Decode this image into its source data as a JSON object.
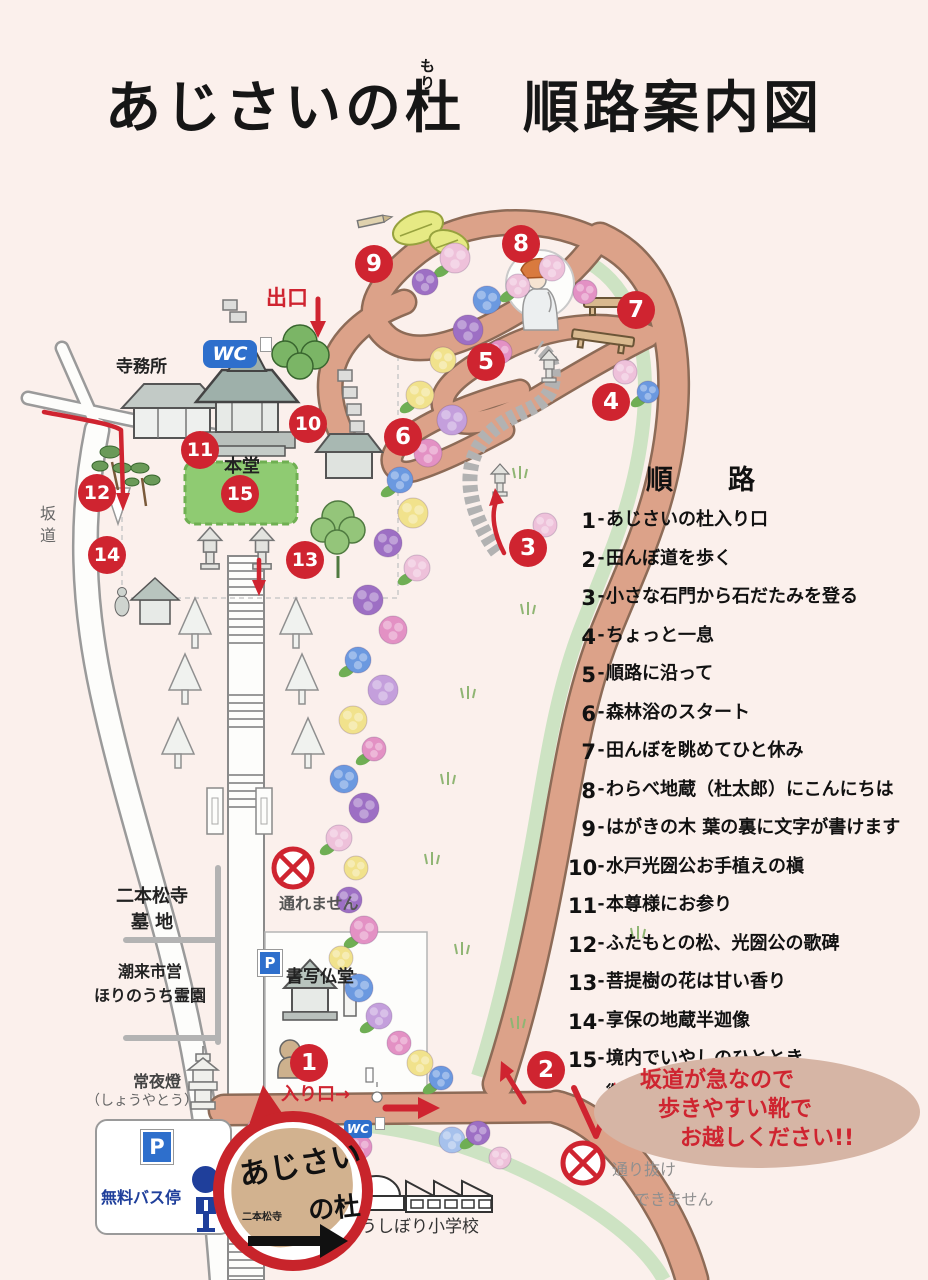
{
  "title": {
    "part1": "あじさいの",
    "mori_kanji": "杜",
    "furigana": "もり",
    "part2": "順路案内図"
  },
  "route": {
    "heading": "順　路",
    "items": [
      {
        "num": "1",
        "text": "あじさいの杜入り口"
      },
      {
        "num": "2",
        "text": "田んぼ道を歩く"
      },
      {
        "num": "3",
        "text": "小さな石門から石だたみを登る"
      },
      {
        "num": "4",
        "text": "ちょっと一息"
      },
      {
        "num": "5",
        "text": "順路に沿って"
      },
      {
        "num": "6",
        "text": "森林浴のスタート"
      },
      {
        "num": "7",
        "text": "田んぼを眺めてひと休み"
      },
      {
        "num": "8",
        "text": "わらべ地蔵（杜太郎）にこんにちは"
      },
      {
        "num": "9",
        "text": "はがきの木 葉の裏に文字が書けます"
      },
      {
        "num": "10",
        "text": "水戸光圀公お手植えの槇"
      },
      {
        "num": "11",
        "text": "本尊様にお参り"
      },
      {
        "num": "12",
        "text": "ふたもとの松、光圀公の歌碑"
      },
      {
        "num": "13",
        "text": "菩提樹の花は甘い香り"
      },
      {
        "num": "14",
        "text": "享保の地蔵半迦像"
      },
      {
        "num": "15",
        "text": "境内でいやしのひととき",
        "text2": "御朱印、護摩木、お守り、お土産など"
      }
    ]
  },
  "notice": {
    "line1": "坂道が急なので",
    "line2": "歩きやすい靴で",
    "line3": "お越しください!!"
  },
  "map": {
    "labels": {
      "exit": "出口",
      "entrance": "入り口→",
      "temple_office": "寺務所",
      "main_hall": "本堂",
      "slope": "坂道",
      "no_pass": "通れません",
      "no_through_1": "通り抜け",
      "no_through_2": "できません",
      "cemetery_1": "二本松寺",
      "cemetery_2": "墓 地",
      "municipal_1": "潮来市営",
      "municipal_2": "ほりのうち霊園",
      "lantern_1": "常夜燈",
      "lantern_2": "（しょうやとう）",
      "bus_stop": "無料バス停",
      "copy_hall": "書写仏堂",
      "school": "うしぼり小学校",
      "wc": "WC",
      "parking": "P"
    },
    "logo": {
      "line1": "あじさい",
      "line2": "の杜",
      "small": "二本松寺"
    },
    "markers": [
      {
        "n": "1",
        "x": 309,
        "y": 1063
      },
      {
        "n": "2",
        "x": 546,
        "y": 1070
      },
      {
        "n": "3",
        "x": 528,
        "y": 548
      },
      {
        "n": "4",
        "x": 611,
        "y": 402
      },
      {
        "n": "5",
        "x": 486,
        "y": 362
      },
      {
        "n": "6",
        "x": 403,
        "y": 437
      },
      {
        "n": "7",
        "x": 636,
        "y": 310
      },
      {
        "n": "8",
        "x": 521,
        "y": 244
      },
      {
        "n": "9",
        "x": 374,
        "y": 264
      },
      {
        "n": "10",
        "x": 308,
        "y": 424
      },
      {
        "n": "11",
        "x": 200,
        "y": 450
      },
      {
        "n": "12",
        "x": 97,
        "y": 493
      },
      {
        "n": "13",
        "x": 305,
        "y": 560
      },
      {
        "n": "14",
        "x": 107,
        "y": 555
      },
      {
        "n": "15",
        "x": 240,
        "y": 494
      }
    ]
  },
  "colors": {
    "accent_red": "#cf2430",
    "path_salmon": "#dca289",
    "path_outline": "#8d6b57",
    "green_strip": "#cde3c3",
    "sign_blue": "#2e6fcc",
    "bus_blue": "#1f3f9b",
    "area15_green": "#8fcb72",
    "oval_tan": "#d6b5a5",
    "flowers": {
      "purple": "#9d6fc4",
      "purple_light": "#c49fdc",
      "pink": "#e391c4",
      "pink_light": "#eec1da",
      "blue": "#6b99e0",
      "blue_light": "#a6c1ec",
      "yellow": "#f1e28c",
      "leaf": "#6fae54"
    }
  }
}
